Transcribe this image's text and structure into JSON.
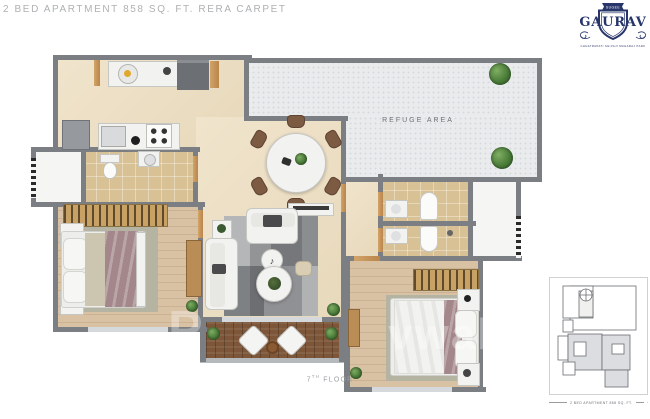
{
  "header": {
    "title": "2 BED APARTMENT 858 SQ. FT. RERA CARPET"
  },
  "logo": {
    "ribbon": "SUGEE",
    "name": "GAURAV",
    "tagline": "CHHATRAPATI SHIVAJI MAHARAJ PARK"
  },
  "plan": {
    "refuge_area_label": "REFUGE AREA",
    "floor_number": "7",
    "floor_ordinal": "TH",
    "floor_word": "FLOOR"
  },
  "key_plan": {
    "caption": "2 BED APARTMENT 858 SQ. FT."
  },
  "watermark": {
    "left": "P",
    "right": "vwal"
  },
  "icons": {
    "music_note": "♪"
  },
  "colors": {
    "wall": "#7b7f83",
    "brand_navy": "#27356a",
    "beige_floor": "#ead9bd",
    "wood_floor": "#d9c2a4",
    "tile_floor": "#d8c194",
    "refuge_floor": "#e9ebed",
    "deck_wood": "#7d5639",
    "plant_green": "#4a7c39",
    "title_gray": "#aeb1b3"
  }
}
